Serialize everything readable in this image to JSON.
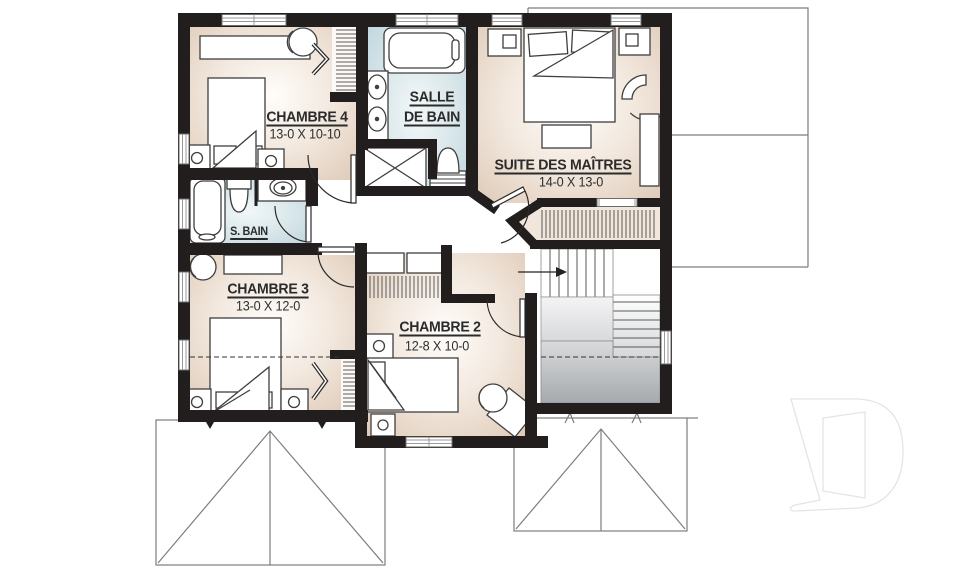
{
  "rooms": {
    "chambre4": {
      "label": "CHAMBRE 4",
      "dims": "13-0 X 10-10"
    },
    "salle_de_bain": {
      "label_line1": "SALLE",
      "label_line2": "DE BAIN"
    },
    "suite": {
      "label": "SUITE DES MAÎTRES",
      "dims": "14-0 X 13-0"
    },
    "s_bain": {
      "label": "S. BAIN"
    },
    "chambre3": {
      "label": "CHAMBRE 3",
      "dims": "13-0 X 12-0"
    },
    "chambre2": {
      "label": "CHAMBRE 2",
      "dims": "12-8 X 10-0"
    }
  },
  "colors": {
    "wall": "#221e1e",
    "room_tan_edge": "#dcc6b2",
    "room_center": "#fffdfb",
    "bath_blue": "#bad3dc",
    "stair_gray": "#a6a9ad",
    "roof_line": "#7d7d7d",
    "watermark": "#e4e4e4"
  }
}
